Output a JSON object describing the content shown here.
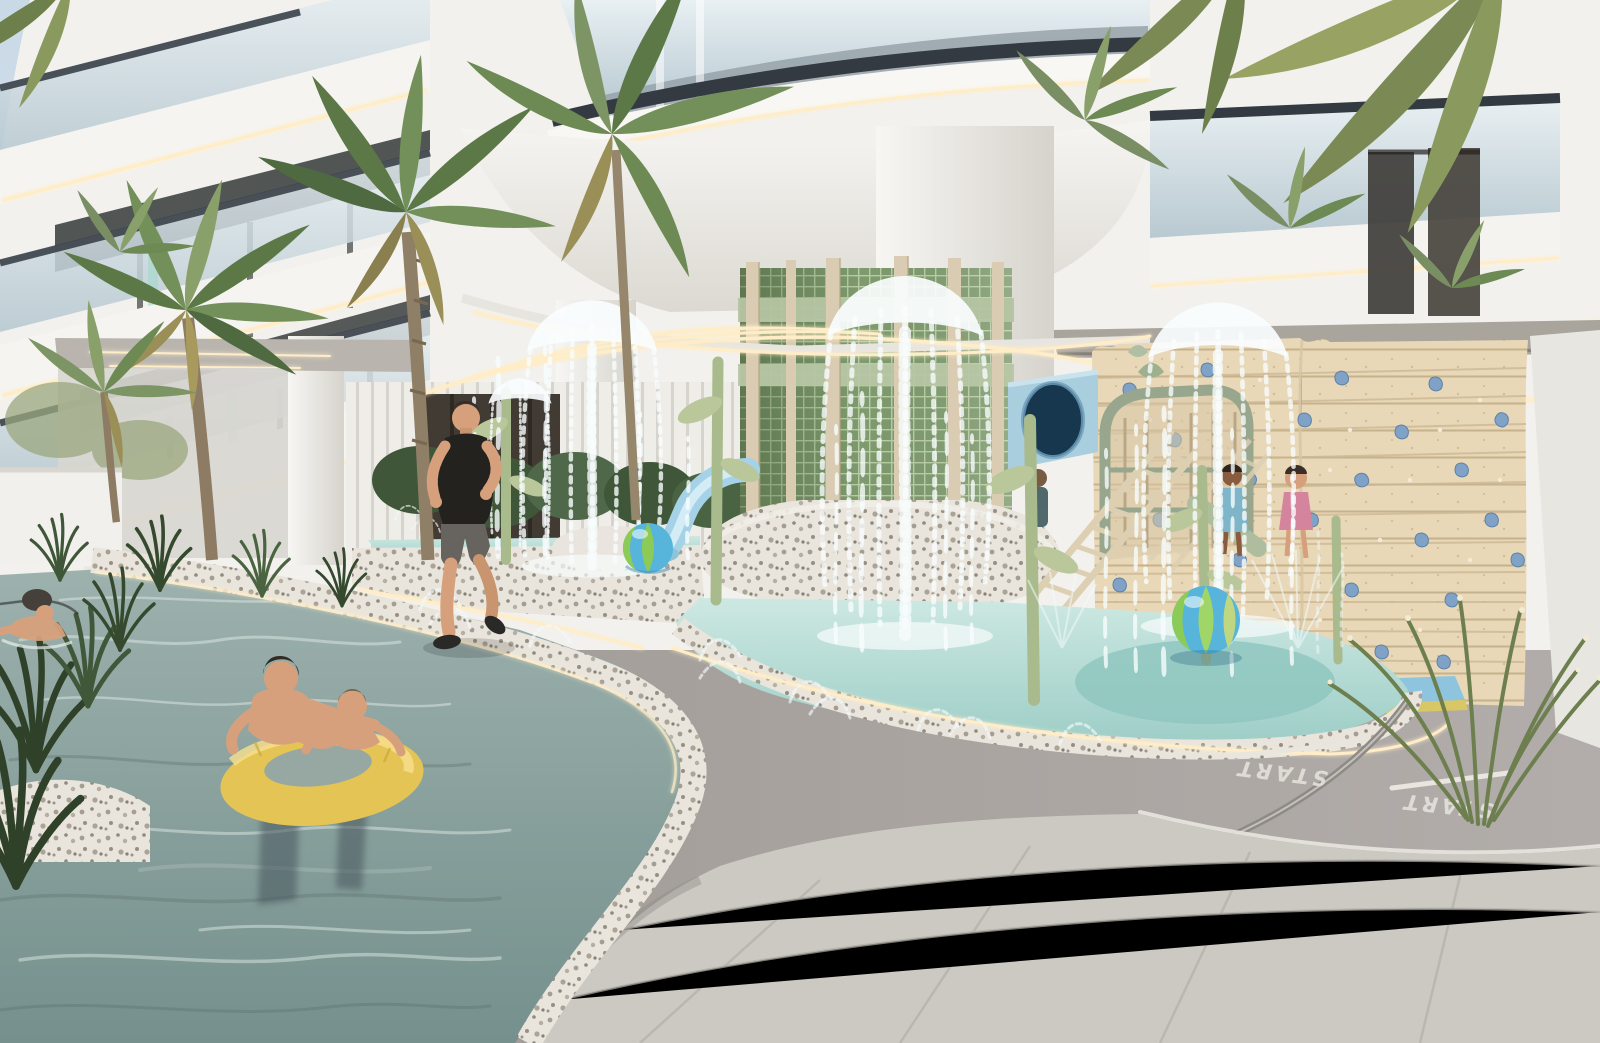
{
  "scene": {
    "title": "Residential tower pool deck with kids splash pad",
    "type": "3d-architectural-rendering",
    "environment": "outdoor resort amenity deck, daytime"
  },
  "track": {
    "start_label": "START",
    "lane_count": 2,
    "surface_color": "#a19b96",
    "marking_color": "#e7e4de"
  },
  "building": {
    "style": "curved white balconies, glass railings, LED cove lighting",
    "facade_color": "#f4f3f0",
    "accent_band_color": "#343a41",
    "glass_color": "#c3d2d9",
    "led_color": "#ffedc8",
    "balcony_plants": true
  },
  "splash_pad": {
    "mushroom_fountain_count": 3,
    "jet_clusters": 3,
    "water_color": "#aed7d0",
    "deck_border": "terrazzo",
    "stem_pole_color": "#a9ba8c"
  },
  "play_area": {
    "climbing_wall": {
      "material": "wood planks",
      "hold_color": "#7fa2c6",
      "dot_color": "#f3ead8",
      "mat_colors": [
        "#8ec4de",
        "#d9c766"
      ]
    },
    "tube_slide_opening_color": "#17374f",
    "water_slide_color": "#a5d2e6",
    "playhouse_frame_color": "#97a68c",
    "rope_ladder_color": "#ddd0b2",
    "children_count": 3
  },
  "pool": {
    "water_color": "#8aa09e",
    "float_ring_color": "#e4c455",
    "curb": "terrazzo with LED edge",
    "swimmers": [
      "man holding boy on yellow ring",
      "lap swimmer in dark cap"
    ]
  },
  "people": {
    "runner": {
      "shirt_color": "#24221f",
      "shorts_color": "#67635f"
    },
    "total_visible": 7
  },
  "beach_balls": [
    {
      "position": "left basin",
      "colors": [
        "#57b5dc",
        "#8ccb58"
      ]
    },
    {
      "position": "right splash pool",
      "colors": [
        "#57b5dc",
        "#8ccb58",
        "#d9e06a"
      ]
    }
  ],
  "vegetation": {
    "palm_trees": 4,
    "overhanging_canopy": "top right",
    "ornamental_grasses": true,
    "greens": [
      "#4f6a40",
      "#73905a",
      "#9a8f57"
    ]
  },
  "materials": {
    "tile_color": "#ccc9c3",
    "terrazzo_base": "#e9e5dc",
    "wood_wall": "#e8d8b8",
    "tower_mesh_green": "#7e9a6e",
    "pole_beige": "#d9ccb2"
  }
}
